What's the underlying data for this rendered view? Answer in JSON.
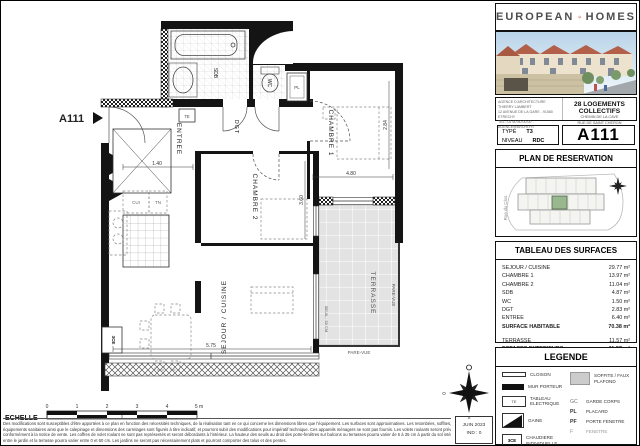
{
  "plan": {
    "ref_label": "A111",
    "rooms": {
      "entree": "ENTREE",
      "dgt": "DGT",
      "sdb": "SDB",
      "wc": "WC",
      "chambre1": "CHAMBRE 1",
      "chambre2": "CHAMBRE 2",
      "sejour": "SEJOUR / CUISINE",
      "terrasse": "TERRASSE"
    },
    "labels": {
      "pare_vue_right": "PARE-VUE",
      "pare_vue_bottom": "PARE-VUE",
      "seuil": "SEUIL : 50 CM",
      "cui": "CUI",
      "tn": "TN",
      "pl": "PL",
      "te": "TE",
      "ce": "3CE"
    },
    "dims": {
      "d1": "4.80",
      "d2": "2.84",
      "d3": "1.40",
      "d4": "3.60",
      "d5": "5.75"
    },
    "compass": {
      "o": "O",
      "e": "E",
      "s": "S"
    }
  },
  "footer": {
    "echelle_label": "ECHELLE",
    "scale_ticks": [
      "0",
      "1",
      "2",
      "3",
      "4",
      "5 m"
    ],
    "disclaimer": [
      "Des modifications sont susceptibles d'être apportées à ce plan en fonction des nécessités techniques, de la réalisation tant en ce qui concerne les dimensions libres que l'équipement. Les surfaces sont approximatives. Les retombées, soffites, faux plafond,",
      "équipements sanitaires ainsi que le calepinage et dimensions des carrelages sont figurés à titre indicatif, et pourront subir des modifications pour impératif technique. Ces appareils ménagers ne sont pas fournis. Les volets roulants seront prévus",
      "conformément à la notice de vente. Les coffres de volet roulant ne sont pas représentés et seront débordants à l'intérieur. La hauteur des seuils au droit des porte-fenêtres sur balcons ou terrasses pourra varier de 5 à 35 cm à partir du sol intérieur. La",
      "entre le jardin et la terrasse pourra varier entre 0 et 60 cm. Les jardins ne seront pas nécessairement plats et pourront comporter des talus et des pentes."
    ],
    "date_box": {
      "line1": "JUIN 2023",
      "line2": "IND : 0"
    }
  },
  "panel": {
    "logo": {
      "left": "EUROPEAN",
      "right": "HOMES",
      "accent": "#c0392b"
    },
    "agency_lines": [
      "AGENCE D'ARCHITECTURE THIERRY LAMBERT",
      "12 AVENUE DE LA GARE - 91580 ETRECHY",
      "TEL : 01 60 80 00 00 - AGENCE@ARCHI.FR"
    ],
    "project": {
      "title": "28 LOGEMENTS COLLECTIFS",
      "sub1": "CHEMIN DE LA CAVE",
      "sub2": "RUE DE SAINT CHERON"
    },
    "unit": {
      "type_label": "TYPE",
      "type_value": "T3",
      "level_label": "NIVEAU",
      "level_value": "RDC",
      "ref": "A111"
    },
    "reservation": {
      "title": "PLAN DE RESERVATION",
      "street": "Rue du Clos"
    },
    "surfaces": {
      "title": "TABLEAU DES SURFACES",
      "rows": [
        {
          "label": "SEJOUR / CUISINE",
          "value": "29.77 m²"
        },
        {
          "label": "CHAMBRE 1",
          "value": "13.97 m²"
        },
        {
          "label": "CHAMBRE 2",
          "value": "11.04 m²"
        },
        {
          "label": "SDB",
          "value": "4.87 m²"
        },
        {
          "label": "WC",
          "value": "1.50 m²"
        },
        {
          "label": "DGT",
          "value": "2.83 m²"
        },
        {
          "label": "ENTREE",
          "value": "6.40 m²"
        },
        {
          "label": "SURFACE HABITABLE",
          "value": "70.38 m²"
        },
        {
          "label": "TERRASSE",
          "value": "11.57 m²"
        },
        {
          "label": "ESPACES EXTERIEURS",
          "value": "11.57 m²"
        }
      ]
    },
    "legend": {
      "title": "LEGENDE",
      "cloison": "CLOISON",
      "mur_porteur": "MUR PORTEUR",
      "tableau_electrique": "TABLEAU ELECTRIQUE",
      "te_symbol": "TE",
      "gaine": "GAINE",
      "chaudiere": "CHAUDIERE INDIVIDUELLE",
      "ce_symbol": "3CE",
      "soffite": "SOFFITE / FAUX PLAFOND",
      "gc_abbr": "GC",
      "gc": "GARDE CORPS",
      "pl_abbr": "PL",
      "pl": "PLACARD",
      "pf_abbr": "PF",
      "pf": "PORTE FENETRE",
      "f_abbr": "F",
      "f": "FENETRE"
    }
  }
}
